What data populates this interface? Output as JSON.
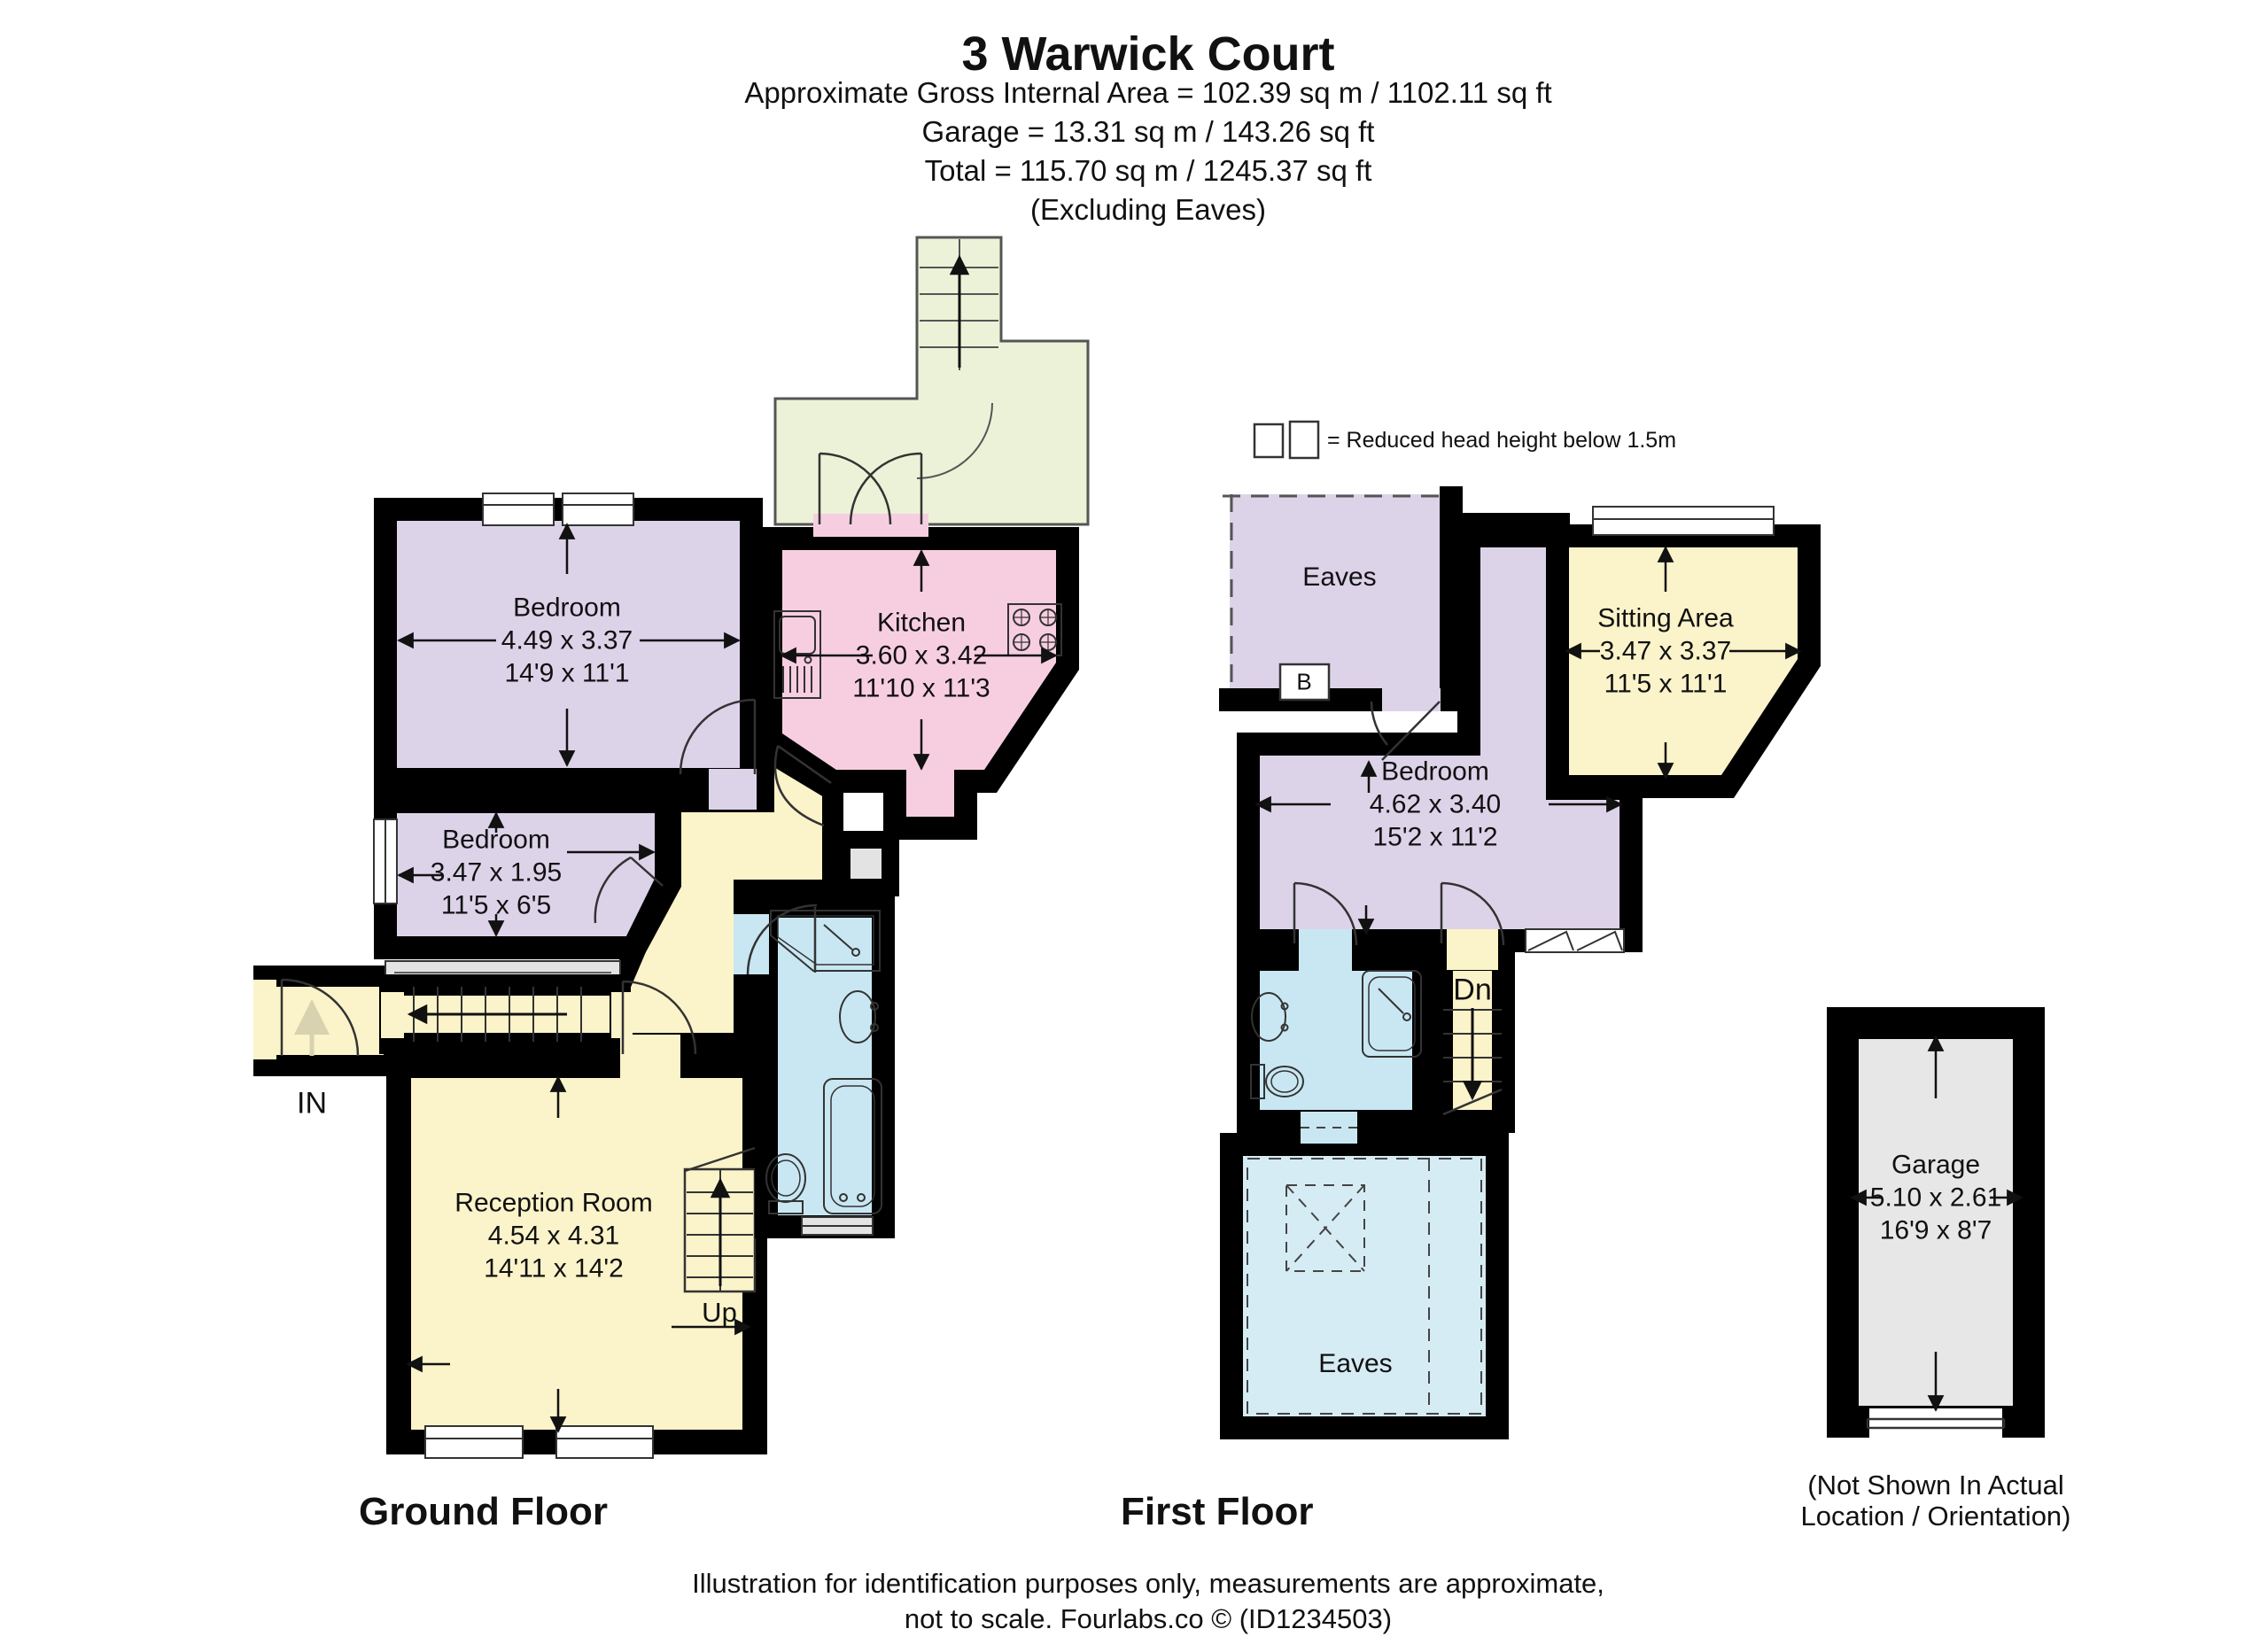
{
  "header": {
    "title": "3 Warwick Court",
    "area_line": "Approximate Gross Internal Area = 102.39 sq m / 1102.11 sq ft",
    "garage_line": "Garage = 13.31 sq m / 143.26 sq ft",
    "total_line": "Total = 115.70 sq m / 1245.37 sq ft",
    "excluding_line": "(Excluding Eaves)"
  },
  "legend": {
    "text": "= Reduced head height below 1.5m"
  },
  "ground": {
    "label": "Ground Floor",
    "rooms": {
      "bedroom1": {
        "name": "Bedroom",
        "metric": "4.49 x 3.37",
        "imperial": "14'9 x 11'1"
      },
      "bedroom2": {
        "name": "Bedroom",
        "metric": "3.47 x 1.95",
        "imperial": "11'5 x 6'5"
      },
      "kitchen": {
        "name": "Kitchen",
        "metric": "3.60 x 3.42",
        "imperial": "11'10 x 11'3"
      },
      "reception": {
        "name": "Reception Room",
        "metric": "4.54 x 4.31",
        "imperial": "14'11 x 14'2"
      }
    },
    "annotations": {
      "in": "IN",
      "up": "Up"
    }
  },
  "first": {
    "label": "First Floor",
    "rooms": {
      "eaves_top": {
        "name": "Eaves"
      },
      "sitting": {
        "name": "Sitting Area",
        "metric": "3.47 x 3.37",
        "imperial": "11'5 x 11'1"
      },
      "bedroom": {
        "name": "Bedroom",
        "metric": "4.62 x 3.40",
        "imperial": "15'2 x 11'2"
      },
      "eaves_bottom": {
        "name": "Eaves"
      }
    },
    "annotations": {
      "dn": "Dn",
      "boiler": "B"
    }
  },
  "garage": {
    "name": "Garage",
    "metric": "5.10 x 2.61",
    "imperial": "16'9 x 8'7",
    "note_line1": "(Not Shown In Actual",
    "note_line2": "Location / Orientation)"
  },
  "footer": {
    "line1": "Illustration for identification purposes only, measurements are approximate,",
    "line2": "not to scale. Fourlabs.co © (ID1234503)"
  },
  "colors": {
    "wall": "#000000",
    "bedroom": "#ddd3e9",
    "kitchen": "#f7cee0",
    "living": "#fbf3c9",
    "outdoor": "#ecf2d8",
    "bath": "#c9e7f2",
    "eaves_blue": "#d6ecf4",
    "grey": "#e3e3e3",
    "garage": "#e7e7e7"
  }
}
